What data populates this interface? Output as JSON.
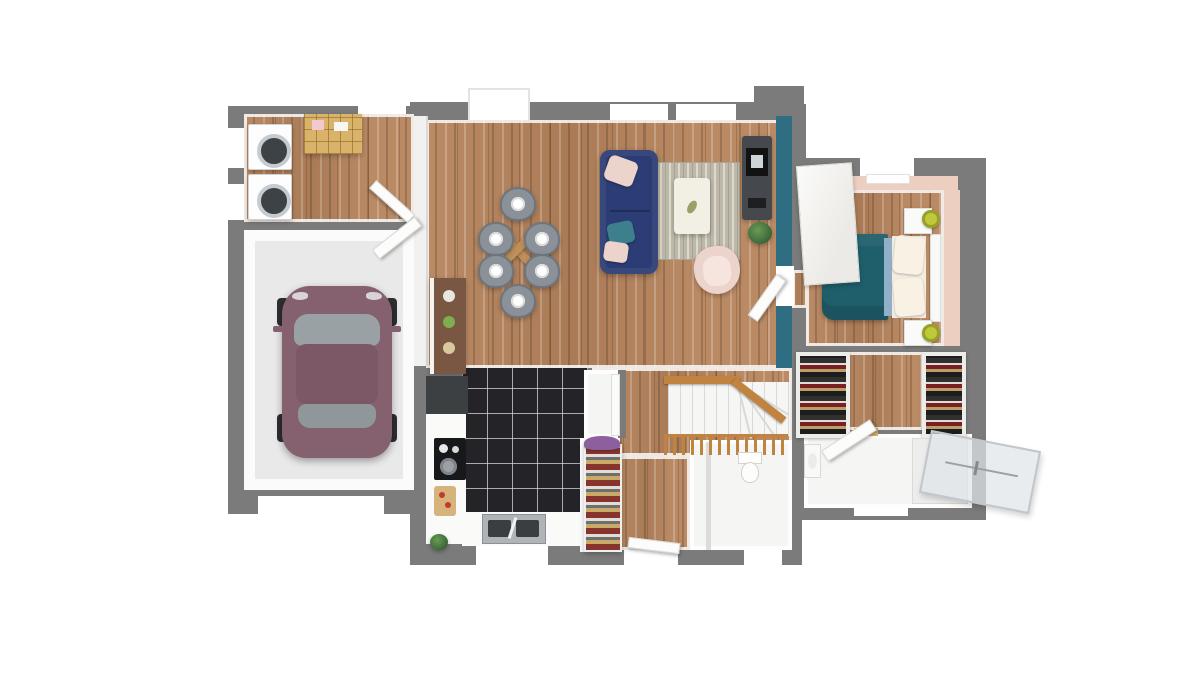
{
  "scene": {
    "type": "3d-floorplan-top-view-render",
    "floor": "ground-floor",
    "background": "#ffffff",
    "visible_text": ""
  },
  "palette": {
    "wall": "#7b7b7b",
    "wood": "#b6845c",
    "garage": "#e9e9e9",
    "tile": "#232328",
    "white": "#ffffff",
    "offwhite": "#f4f4f2",
    "teal": "#2f6e82",
    "tealbed": "#1f5f6b",
    "navy": "#2c3c74",
    "pinkchair": "#ecd3cc",
    "pinkwall": "#eccfc0",
    "rug": "#bdb8a8",
    "chair": "#8a9199",
    "tablewood": "#c0905a",
    "rail": "#c08440",
    "lamp": "#bfc939",
    "car": "#85606e",
    "carglass": "#99a1a5",
    "cabinet": "#45494e",
    "browncab": "#7a5743",
    "shelf": "#d9b36a",
    "plant": "#3f6b3a",
    "glass": "#dfe4e8",
    "sink": "#aeb4b8",
    "washerdoor": "#3c4246",
    "toilet": "#fdfdfc"
  },
  "rooms": [
    {
      "id": "laundry",
      "furniture": [
        "washing-machine",
        "washing-machine",
        "wood-shelf-unit",
        "door"
      ]
    },
    {
      "id": "garage",
      "furniture": [
        "car-mauve",
        "garage-opening",
        "door-to-house"
      ]
    },
    {
      "id": "living-dining",
      "furniture": [
        "dining-table-cross",
        "six-gray-chairs",
        "navy-sofa",
        "area-rug",
        "coffee-table",
        "pink-armchair",
        "tv-cabinet",
        "plant",
        "teal-accent-wall"
      ]
    },
    {
      "id": "kitchen",
      "furniture": [
        "tall-brown-cabinet",
        "dark-corner-cabinet",
        "cooktop-with-pot",
        "cutting-board",
        "double-sink",
        "plant",
        "black-tile-floor"
      ]
    },
    {
      "id": "entry",
      "furniture": [
        "shoe-rack",
        "front-door"
      ]
    },
    {
      "id": "staircase",
      "furniture": [
        "winder-stairs",
        "wood-handrail",
        "wood-balustrade"
      ]
    },
    {
      "id": "wc",
      "furniture": [
        "toilet",
        "window"
      ]
    },
    {
      "id": "bedroom",
      "furniture": [
        "double-bed-teal",
        "white-wardrobe",
        "nightstand",
        "nightstand",
        "lamp-yellow",
        "lamp-yellow",
        "window-radiator"
      ]
    },
    {
      "id": "dressing",
      "furniture": [
        "wardrobe-clothes",
        "wardrobe-clothes"
      ]
    },
    {
      "id": "bathroom",
      "furniture": [
        "walk-in-shower",
        "glass-screen",
        "washbasin",
        "door"
      ]
    }
  ]
}
